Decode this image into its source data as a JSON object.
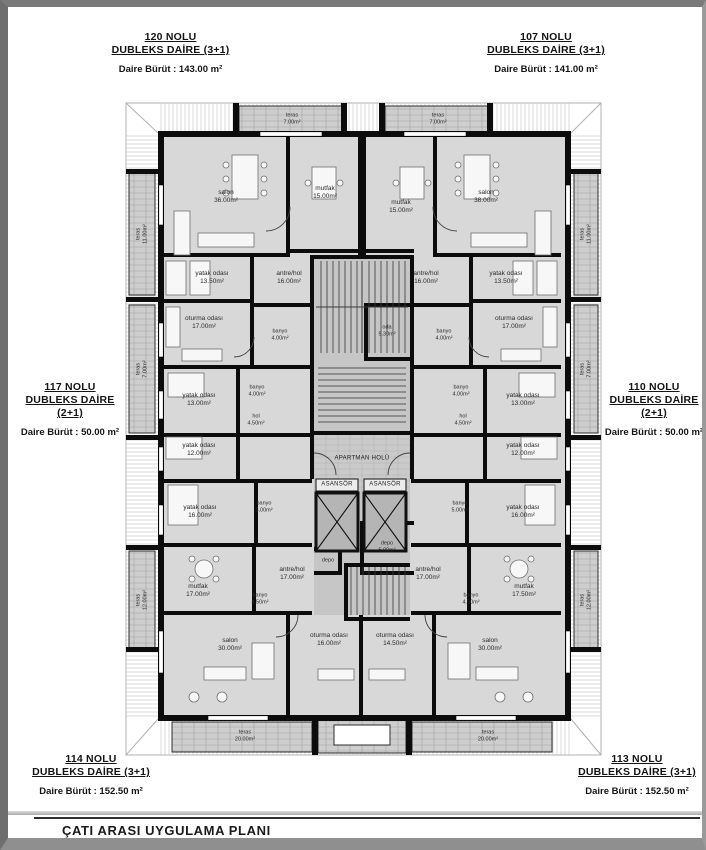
{
  "drawing": {
    "title": "ÇATI ARASI UYGULAMA PLANI"
  },
  "palette": {
    "wall": "#0c0c0c",
    "floor": "#d8d8d8",
    "core": "#c6c6c6",
    "terrace": "#cdcdcd",
    "roof_hatch": "#c9c9c9"
  },
  "units": {
    "u120": {
      "no": "120 NOLU",
      "type": "DUBLEKS DAİRE  (3+1)",
      "plan": "",
      "area": "Daire Bürüt  : 143.00 m²"
    },
    "u107": {
      "no": "107 NOLU",
      "type": "DUBLEKS DAİRE  (3+1)",
      "plan": "",
      "area": "Daire Bürüt  : 141.00 m²"
    },
    "u117": {
      "no": "117 NOLU",
      "type": "DUBLEKS DAİRE",
      "plan": "(2+1)",
      "area": "Daire Bürüt   : 50.00 m²"
    },
    "u110": {
      "no": "110 NOLU",
      "type": "DUBLEKS DAİRE",
      "plan": "(2+1)",
      "area": "Daire Bürüt   : 50.00 m²"
    },
    "u114": {
      "no": "114 NOLU",
      "type": "DUBLEKS DAİRE  (3+1)",
      "plan": "",
      "area": "Daire Bürüt   : 152.50 m²"
    },
    "u113": {
      "no": "113 NOLU",
      "type": "DUBLEKS DAİRE  (3+1)",
      "plan": "",
      "area": "Daire Bürüt   : 152.50 m²"
    }
  },
  "core": {
    "apartman_holu": "APARTMAN HOLÜ",
    "asansor": "ASANSÖR",
    "depo_big": {
      "name": "depo",
      "area": "5.00m²"
    },
    "depo_small": {
      "name": "depo",
      "area": ""
    },
    "oda": {
      "name": "oda",
      "area": "5.30m²"
    }
  },
  "rooms": {
    "salon_120": {
      "name": "salon",
      "area": "36.00m²"
    },
    "mutfak_120": {
      "name": "mutfak",
      "area": "15.00m²"
    },
    "yatak_120": {
      "name": "yatak odası",
      "area": "13.50m²"
    },
    "antre_120": {
      "name": "antre/hol",
      "area": "16.00m²"
    },
    "oturma_120": {
      "name": "oturma odası",
      "area": "17.00m²"
    },
    "banyo_120": {
      "name": "banyo",
      "area": "4.00m²"
    },
    "teras_top_left": {
      "name": "teras",
      "area": "7.00m²"
    },
    "teras_left_11": {
      "name": "teras",
      "area": "11.00m²"
    },
    "salon_107": {
      "name": "salon",
      "area": "38.00m²"
    },
    "mutfak_107": {
      "name": "mutfak",
      "area": "15.00m²"
    },
    "yatak_107": {
      "name": "yatak odası",
      "area": "13.50m²"
    },
    "antre_107": {
      "name": "antre/hol",
      "area": "16.00m²"
    },
    "oturma_107": {
      "name": "oturma odası",
      "area": "17.00m²"
    },
    "banyo_107": {
      "name": "banyo",
      "area": "4.00m²"
    },
    "teras_top_right": {
      "name": "teras",
      "area": "7.00m²"
    },
    "teras_right_11": {
      "name": "teras",
      "area": "11.00m²"
    },
    "yatak13_117": {
      "name": "yatak odası",
      "area": "13.00m²"
    },
    "hol_117": {
      "name": "hol",
      "area": "4.50m²"
    },
    "yatak12_117": {
      "name": "yatak odası",
      "area": "12.00m²"
    },
    "banyo_117": {
      "name": "banyo",
      "area": "4.00m²"
    },
    "teras_left_7": {
      "name": "teras",
      "area": "7.00m²"
    },
    "yatak13_110": {
      "name": "yatak odası",
      "area": "13.00m²"
    },
    "hol_110": {
      "name": "hol",
      "area": "4.50m²"
    },
    "yatak12_110": {
      "name": "yatak odası",
      "area": "12.00m²"
    },
    "banyo_110": {
      "name": "banyo",
      "area": "4.00m²"
    },
    "teras_right_7": {
      "name": "teras",
      "area": "7.00m²"
    },
    "yatak16_114": {
      "name": "yatak odası",
      "area": "16.00m²"
    },
    "banyo5_114": {
      "name": "banyo",
      "area": "5.00m²"
    },
    "mutfak_114": {
      "name": "mutfak",
      "area": "17.00m²"
    },
    "antre_114": {
      "name": "antre/hol",
      "area": "17.00m²"
    },
    "banyo45_114": {
      "name": "banyo",
      "area": "4.50m²"
    },
    "salon_114": {
      "name": "salon",
      "area": "30.00m²"
    },
    "oturma_114": {
      "name": "oturma odası",
      "area": "16.00m²"
    },
    "teras_b_left": {
      "name": "teras",
      "area": "20.00m²"
    },
    "teras_left_12": {
      "name": "teras",
      "area": "12.00m²"
    },
    "yatak16_113": {
      "name": "yatak odası",
      "area": "16.00m²"
    },
    "banyo5_113": {
      "name": "banyo",
      "area": "5.00m²"
    },
    "mutfak_113": {
      "name": "mutfak",
      "area": "17.50m²"
    },
    "antre_113": {
      "name": "antre/hol",
      "area": "17.00m²"
    },
    "banyo45_113": {
      "name": "banyo",
      "area": "4.50m²"
    },
    "salon_113": {
      "name": "salon",
      "area": "30.00m²"
    },
    "oturma_113": {
      "name": "oturma odası",
      "area": "14.50m²"
    },
    "teras_b_right": {
      "name": "teras",
      "area": "20.00m²"
    },
    "teras_right_12": {
      "name": "teras",
      "area": "12.00m²"
    }
  }
}
